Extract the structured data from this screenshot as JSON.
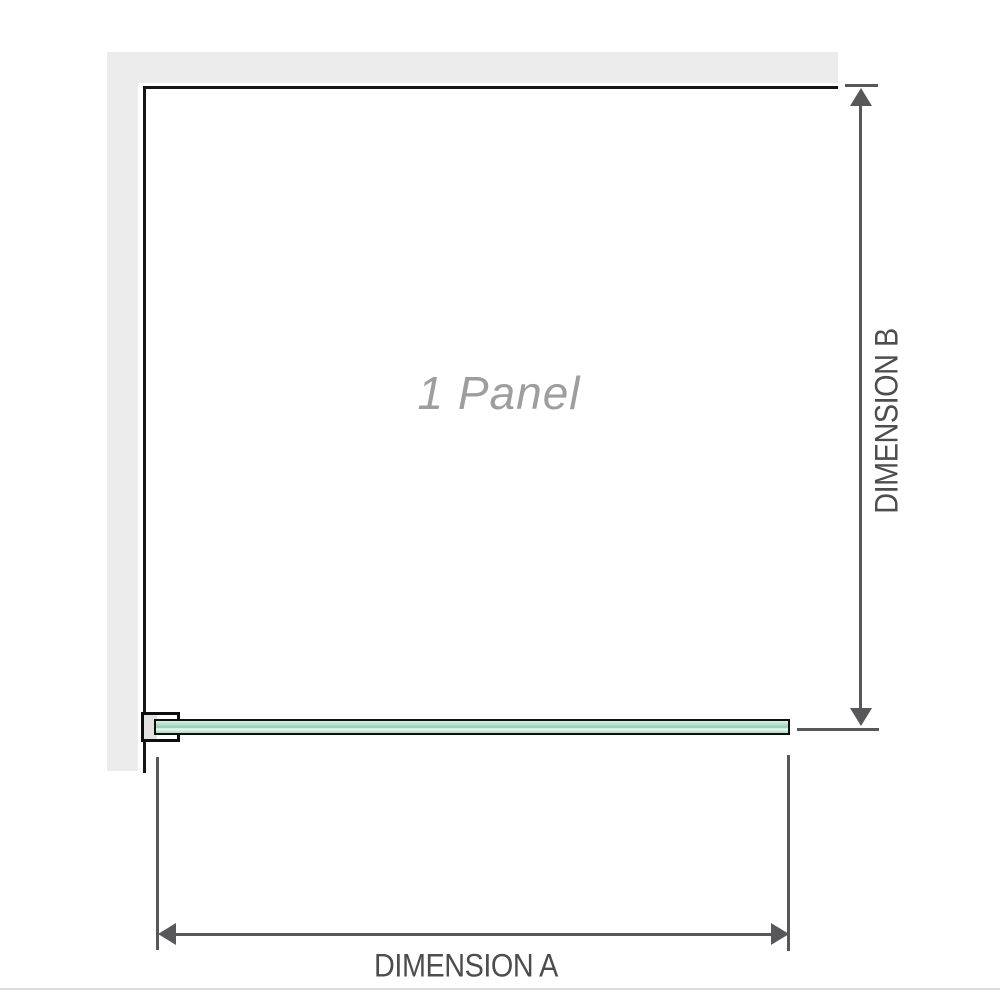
{
  "diagram": {
    "panel_label": "1 Panel",
    "dimension_a_label": "DIMENSION A",
    "dimension_b_label": "DIMENSION B"
  },
  "icons": {
    "dim_a_left": "arrow-left-icon",
    "dim_a_right": "arrow-right-icon",
    "dim_b_up": "arrow-up-icon",
    "dim_b_down": "arrow-down-icon"
  },
  "colors": {
    "wall": "#ececec",
    "outline": "#161616",
    "dimension": "#58585a",
    "label_text": "#4d4d4d",
    "panel_text": "#9e9e9e",
    "glass_green": "#a9dcc2",
    "glass_green_light": "#d9f0e4",
    "glass_green_dark": "#8fcbaf",
    "bracket_fill": "#e2e2e2",
    "divider": "#dcdcdc"
  }
}
